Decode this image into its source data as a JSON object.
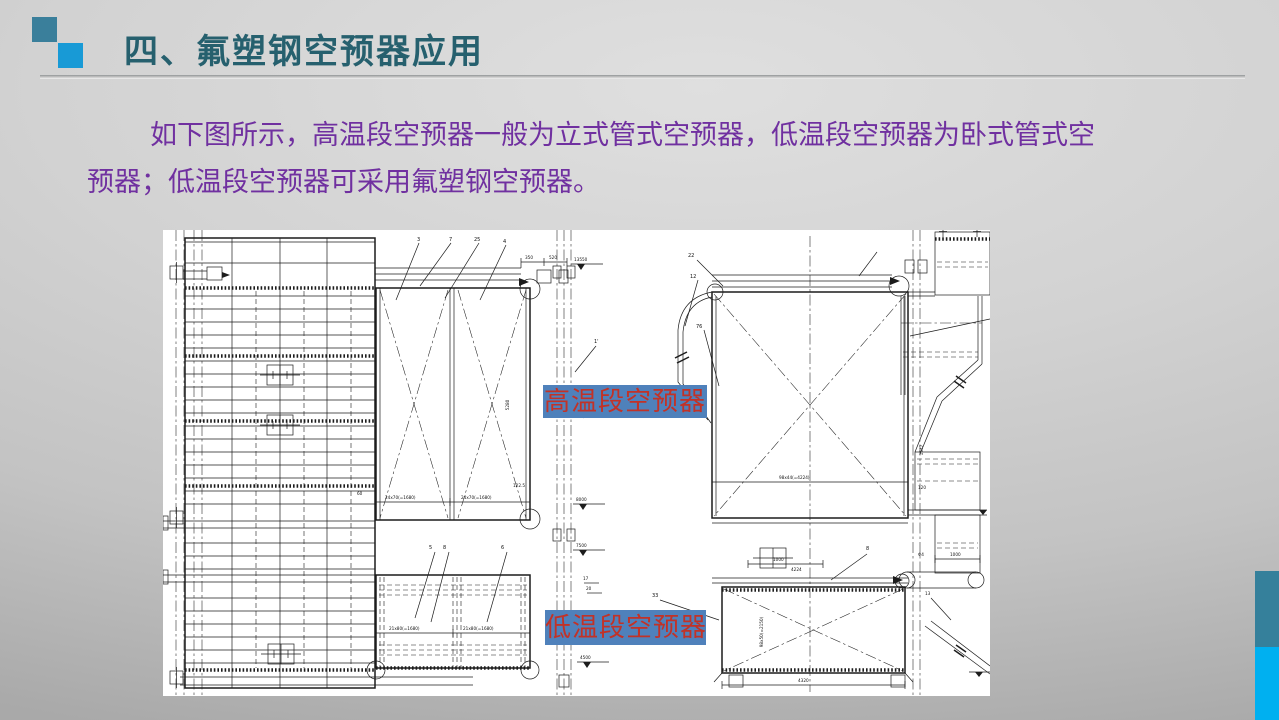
{
  "slide": {
    "title": "四、氟塑钢空预器应用",
    "paragraph": "如下图所示，高温段空预器一般为立式管式空预器，低温段空预器为卧式管式空预器；低温段空预器可采用氟塑钢空预器。",
    "colors": {
      "title_text": "#26606e",
      "paragraph_text": "#7030a0",
      "square_dark": "#3a7f9b",
      "square_light": "#189ad6",
      "edge_bar_teal": "#35809b",
      "edge_bar_blue": "#00b0f0",
      "label_background": "#4f81bb",
      "label_text": "#c23227",
      "drawing_background": "#ffffff"
    }
  },
  "drawing": {
    "high_temp_label": "高温段空预器",
    "low_temp_label": "低温段空预器",
    "annotations": {
      "n3": "3",
      "n7": "7",
      "n25": "25",
      "n4": "4",
      "d350": "350",
      "d520": "520",
      "e13550": "13550",
      "e8000": "8000",
      "e7500": "7500",
      "e4500": "4500",
      "n1p": "1'",
      "n16": "16",
      "n17": "17",
      "n20": "20",
      "d122": "122.5",
      "d60": "60",
      "d24a": "24x70(=1680)",
      "d24b": "24x70(=1680)",
      "d5280": "5280",
      "d21a": "21x80(=1680)",
      "d21b": "21x80(=1680)",
      "n5": "5",
      "n8": "8",
      "n6": "6",
      "n22": "22",
      "n12": "12",
      "n76": "76",
      "n8p": "8",
      "n33": "33",
      "n13": "13",
      "d98x44": "98x44(=4224)",
      "d1547": "1547",
      "d1000a": "1000",
      "d4224": "4224",
      "d98x50": "98x50(=2150)",
      "d4320": "4320",
      "d120": "120",
      "dphi": "Φ4",
      "d1000b": "1000"
    }
  }
}
